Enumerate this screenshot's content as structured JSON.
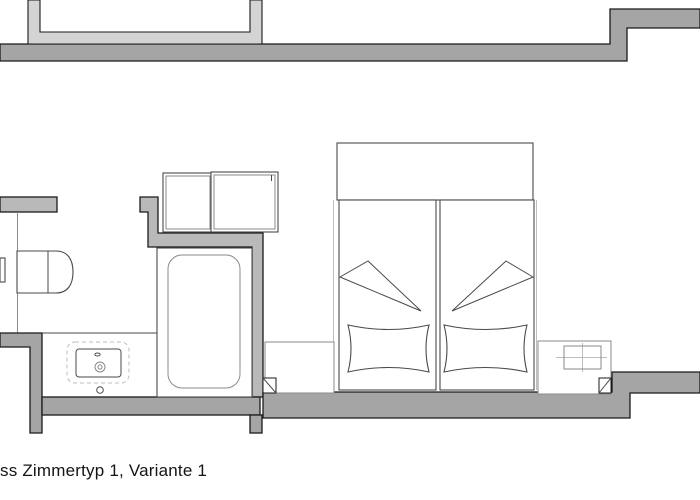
{
  "caption": "ss Zimmertyp 1, Variante 1",
  "colors": {
    "bg": "#ffffff",
    "wall": "#a5a5a5",
    "wall_medium": "#b9b9b9",
    "wall_light": "#d4d4d4",
    "outline": "#1a1a1a",
    "line_dark": "#4a4a4a",
    "line_mid": "#8a8a8a",
    "line_light": "#bdbdbd"
  },
  "plan": {
    "type": "architectural-floor-plan",
    "elements": [
      "exterior-wall-top",
      "wall-niche-top",
      "entry-wall-stub",
      "toilet",
      "flush-plate",
      "washbasin-counter",
      "washbasin",
      "bathtub",
      "bathroom-partition-wall",
      "bathroom-bottom-wall",
      "wardrobe-left",
      "wardrobe-right",
      "double-bed",
      "pillow-left",
      "pillow-right",
      "blanket-fold-left",
      "blanket-fold-right",
      "nightstand-left",
      "nightstand-right",
      "facade-wall-bottom",
      "wall-step-right",
      "window-reveal-left",
      "window-reveal-right"
    ]
  }
}
